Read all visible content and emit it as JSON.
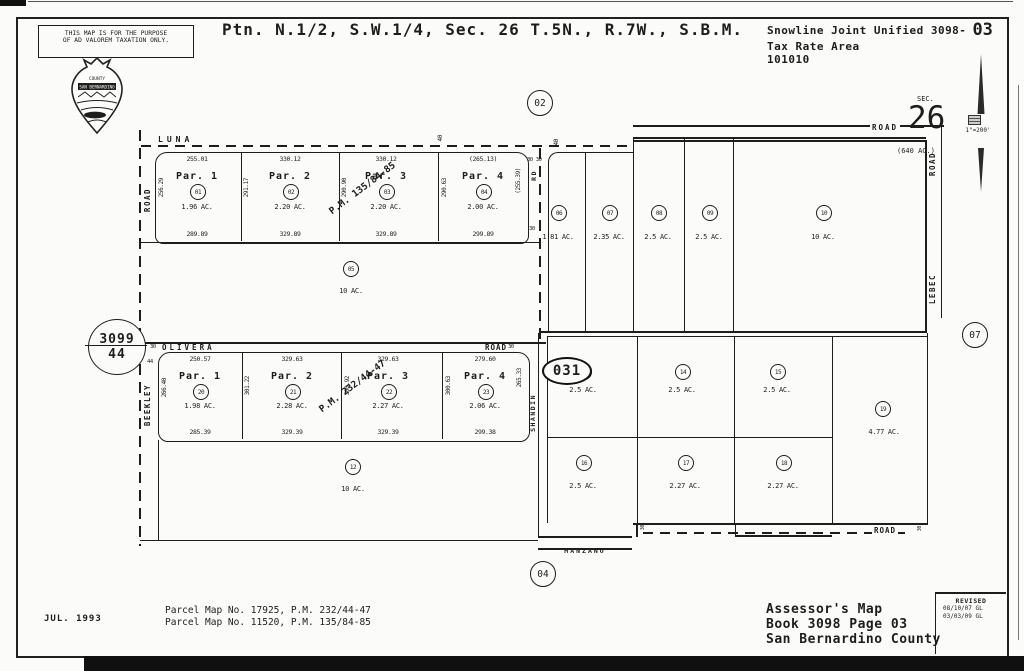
{
  "header": {
    "disclaimer": [
      "THIS MAP IS FOR THE PURPOSE",
      "OF AD VALOREM TAXATION ONLY."
    ],
    "title": "Ptn. N.1/2, S.W.1/4, Sec. 26 T.5N., R.7W., S.B.M.",
    "tax_district": "Snowline Joint Unified 3098-",
    "tax_page": "03",
    "tax_label": "Tax Rate Area",
    "tax_code": "101010"
  },
  "compass": {
    "sec": "SEC.",
    "section": "26",
    "acres": "(640 AC.)",
    "scale": "1\"=200'"
  },
  "adjacent": {
    "north": "02",
    "south": "04",
    "east": "07"
  },
  "map_ref": {
    "book": "3099",
    "page": "44"
  },
  "block_id": "031",
  "roads": {
    "luna": "LUNA",
    "olivera": "OLIVERA",
    "manzano": "MANZANO",
    "beekley": "BEEKLEY",
    "shandin": "SHANDIN",
    "lebec": "LEBEC",
    "road": "ROAD",
    "rd": "RD"
  },
  "ticks": {
    "w40": "40",
    "w30": "30",
    "w44": "44",
    "w3030": "30 30"
  },
  "row1": {
    "pm": "P.M. 135/84-85",
    "parcels": [
      {
        "name": "Par. 1",
        "num": "01",
        "area": "1.96 AC.",
        "top": "255.01",
        "bottom": "289.89",
        "side": "256.29"
      },
      {
        "name": "Par. 2",
        "num": "02",
        "area": "2.20 AC.",
        "top": "330.12",
        "bottom": "329.89",
        "side": "291.17"
      },
      {
        "name": "Par. 3",
        "num": "03",
        "area": "2.20 AC.",
        "top": "330.12",
        "bottom": "329.89",
        "side": "290.90"
      },
      {
        "name": "Par. 4",
        "num": "04",
        "area": "2.00 AC.",
        "top": "(265.13)",
        "bottom": "299.89",
        "side": "290.63",
        "right": "(255.39)"
      }
    ]
  },
  "row2": {
    "pm": "P.M. 232/44-47",
    "parcels": [
      {
        "name": "Par. 1",
        "num": "20",
        "area": "1.98 AC.",
        "top": "250.57",
        "bottom": "285.39",
        "side": "266.40"
      },
      {
        "name": "Par. 2",
        "num": "21",
        "area": "2.28 AC.",
        "top": "329.63",
        "bottom": "329.39",
        "side": "301.22"
      },
      {
        "name": "Par. 3",
        "num": "22",
        "area": "2.27 AC.",
        "top": "329.63",
        "bottom": "329.39",
        "side": "300.92"
      },
      {
        "name": "Par. 4",
        "num": "23",
        "area": "2.06 AC.",
        "top": "279.60",
        "bottom": "299.38",
        "side": "300.63",
        "right": "265.33"
      }
    ]
  },
  "east_top": [
    {
      "num": "06",
      "area": "1.81 AC."
    },
    {
      "num": "07",
      "area": "2.35 AC."
    },
    {
      "num": "08",
      "area": "2.5 AC."
    },
    {
      "num": "09",
      "area": "2.5 AC."
    },
    {
      "num": "10",
      "area": "10 AC."
    }
  ],
  "large": [
    {
      "num": "05",
      "area": "10 AC."
    },
    {
      "num": "12",
      "area": "10 AC."
    }
  ],
  "east_mid": [
    {
      "num": "13",
      "area": "2.5 AC."
    },
    {
      "num": "14",
      "area": "2.5 AC."
    },
    {
      "num": "15",
      "area": "2.5 AC."
    },
    {
      "num": "19",
      "area": "4.77 AC."
    }
  ],
  "east_bot": [
    {
      "num": "16",
      "area": "2.5 AC."
    },
    {
      "num": "17",
      "area": "2.27 AC."
    },
    {
      "num": "18",
      "area": "2.27 AC."
    }
  ],
  "footer": {
    "date": "JUL. 1993",
    "refs": [
      "Parcel Map No. 17925, P.M. 232/44-47",
      "Parcel Map No. 11520, P.M. 135/84-85"
    ],
    "assessor": [
      "Assessor's Map",
      "Book 3098 Page 03",
      "San Bernardino County"
    ],
    "revised_label": "REVISED",
    "revised": [
      "08/10/07 GL",
      "03/03/09 GL"
    ]
  }
}
